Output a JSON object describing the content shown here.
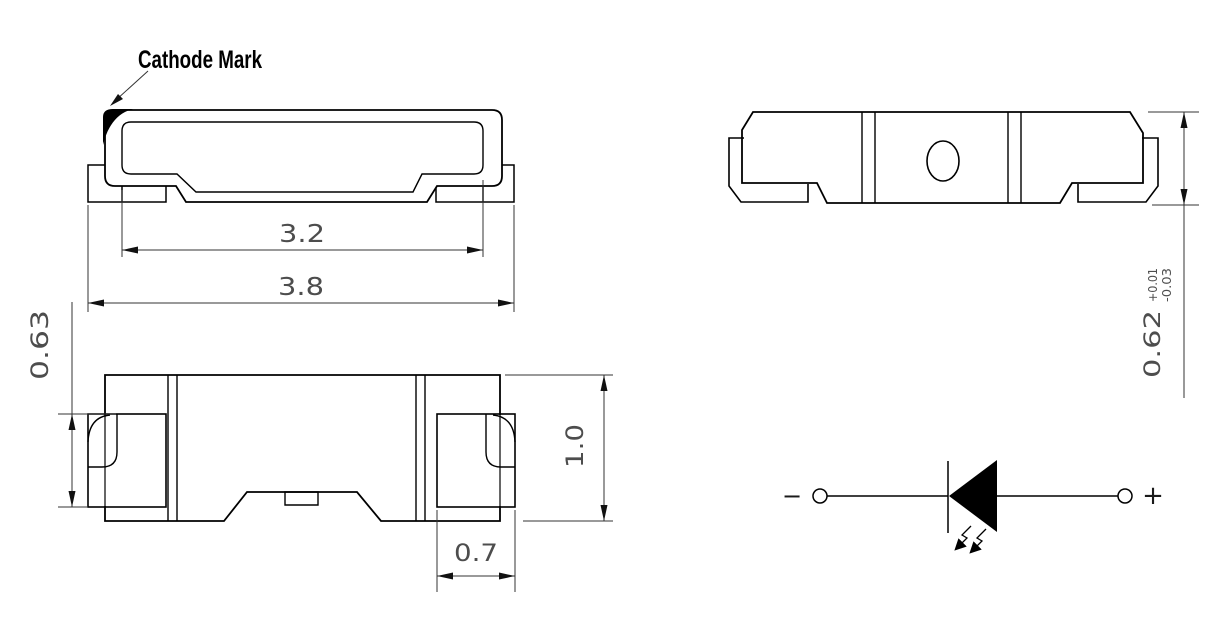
{
  "callouts": {
    "cathode_mark": "Cathode Mark"
  },
  "dimensions": {
    "top_inner_width": "3.2",
    "top_overall_width": "3.8",
    "front_lead_height": "0.63",
    "front_body_height": "1.0",
    "front_lead_width": "0.7",
    "side_height": "0.62",
    "side_height_tol_upper": "+0.01",
    "side_height_tol_lower": "-0.03"
  },
  "schematic": {
    "negative": "−",
    "positive": "+"
  },
  "colors": {
    "line": "#000000",
    "dim_text": "#4d4d4d",
    "background": "#ffffff"
  }
}
